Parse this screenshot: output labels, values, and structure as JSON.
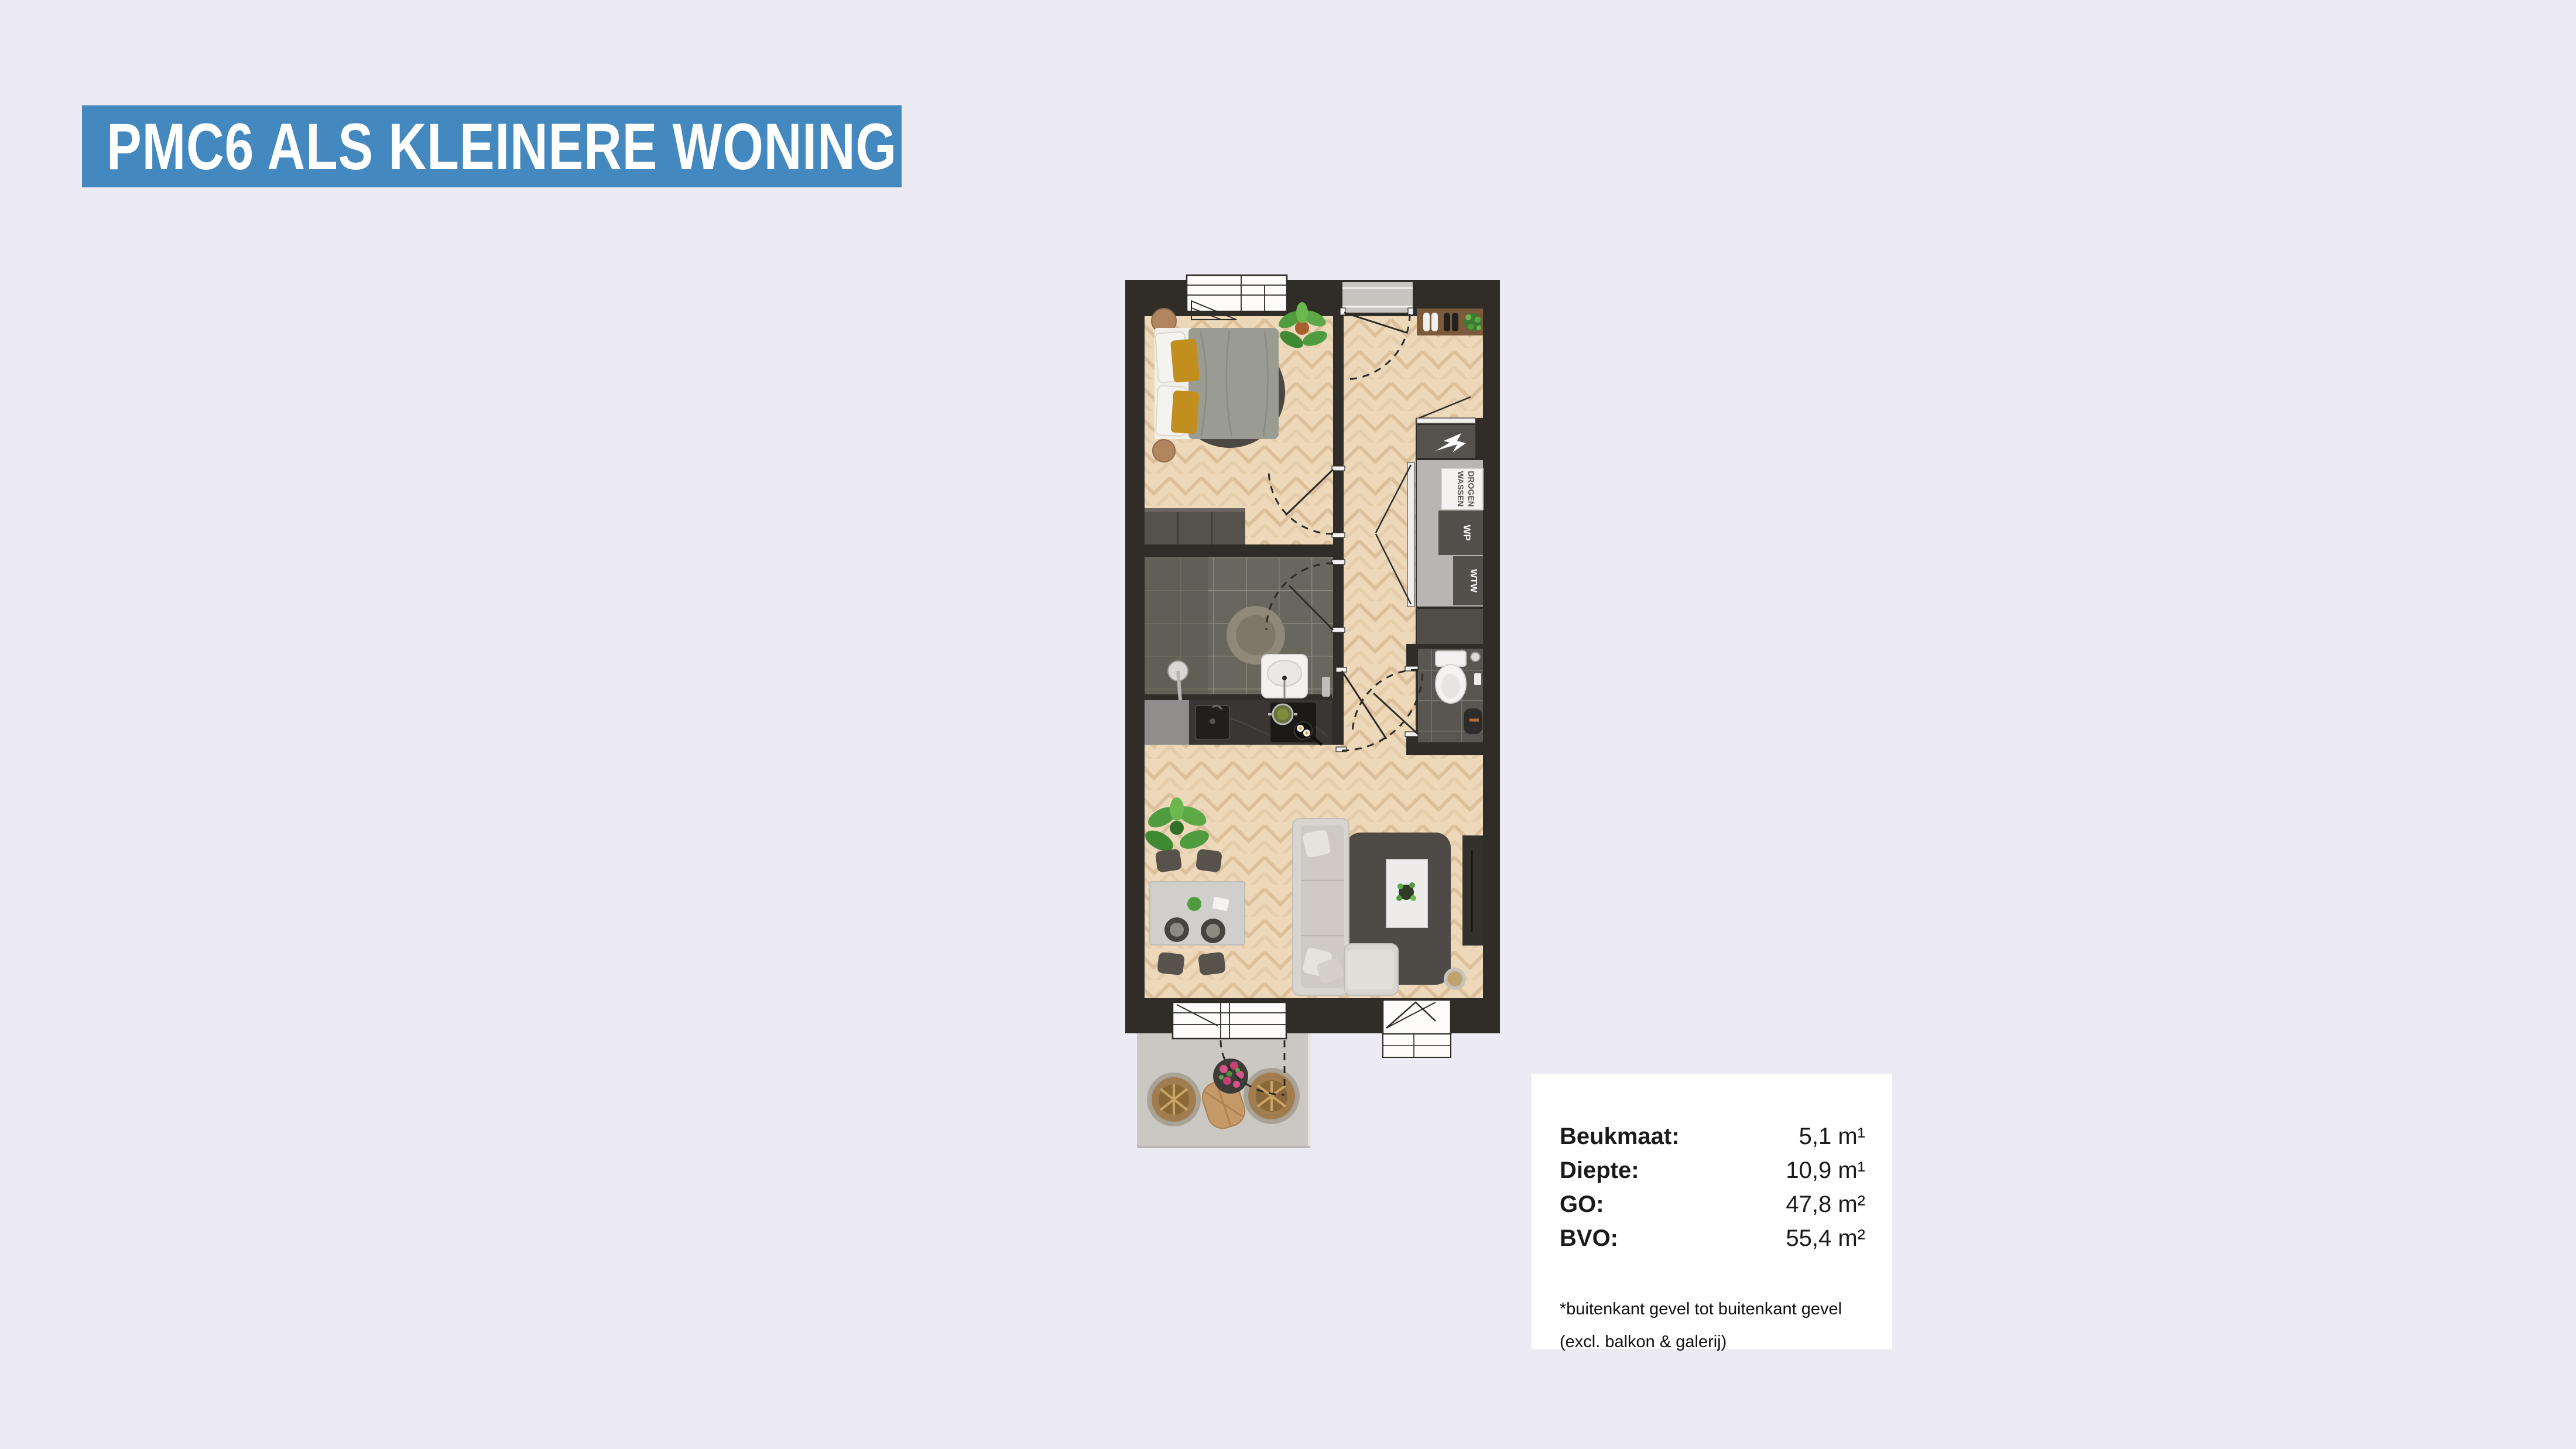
{
  "page": {
    "background": "#ECEAF2"
  },
  "header": {
    "title": "PMC6 ALS KLEINERE WONING",
    "background": "#4388BE",
    "text_color": "#FFFFFF"
  },
  "floorplan": {
    "labels": {
      "wassen": "WASSEN",
      "drogen": "DROGEN",
      "wp": "WP",
      "wtw": "WTW"
    },
    "colors": {
      "wall": "#302C28",
      "wood_floor": "#EDD9BA",
      "tiles": "#68665D",
      "tiles_dark": "#585650",
      "closet": "#B8B6B3",
      "counter": "#3A3633",
      "rug": "#4E4A45",
      "balcony": "#CBC8C4",
      "bed_duvet": "#9A9C92",
      "pillow_accent": "#C28E1E",
      "sofa": "#D8D5D0"
    }
  },
  "info_box": {
    "rows": [
      {
        "label": "Beukmaat:",
        "value": "5,1 m¹"
      },
      {
        "label": "Diepte:",
        "value": "10,9 m¹"
      },
      {
        "label": "GO:",
        "value": "47,8 m²"
      },
      {
        "label": "BVO:",
        "value": "55,4 m²"
      }
    ],
    "footnote_line1": "*buitenkant gevel tot buitenkant gevel",
    "footnote_line2": "(excl. balkon & galerij)"
  }
}
